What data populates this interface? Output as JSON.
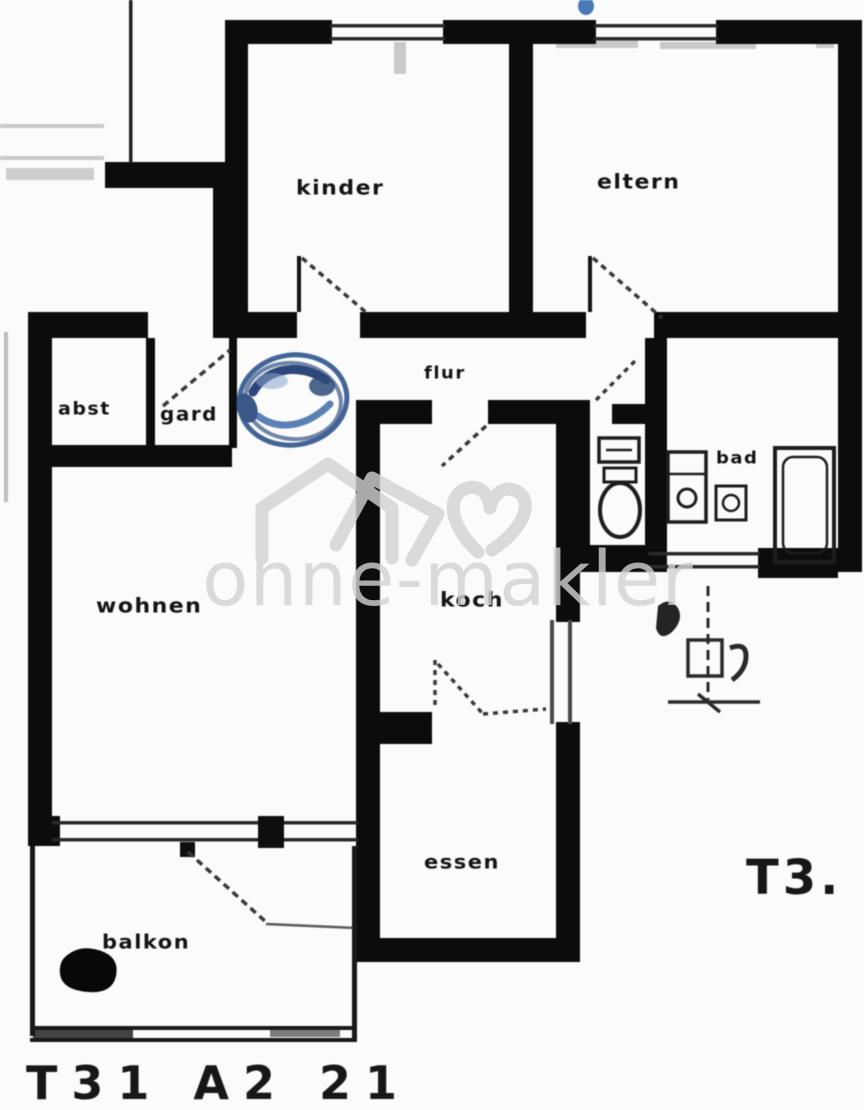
{
  "document": {
    "kind": "scanned apartment floor plan",
    "paper_color": "#fbfbfb",
    "ink_color": "#111111"
  },
  "rooms": [
    {
      "name": "kinder",
      "label": "kinder"
    },
    {
      "name": "eltern",
      "label": "eltern"
    },
    {
      "name": "flur",
      "label": "flur"
    },
    {
      "name": "abst",
      "label": "abst"
    },
    {
      "name": "gard",
      "label": "gard"
    },
    {
      "name": "wohnen",
      "label": "wohnen"
    },
    {
      "name": "koch",
      "label": "koch"
    },
    {
      "name": "essen",
      "label": "essen"
    },
    {
      "name": "bad",
      "label": "bad"
    },
    {
      "name": "balkon",
      "label": "balkon"
    }
  ],
  "codes": {
    "right": "T3.",
    "bottom": "T31 A2 21"
  },
  "watermark": {
    "text": "ohne-makler",
    "logo": "house-heart-logo",
    "color": "#d2d2d2"
  },
  "stamp": {
    "type": "blue-ink-signature-stamp",
    "color": "#2f4f86"
  }
}
